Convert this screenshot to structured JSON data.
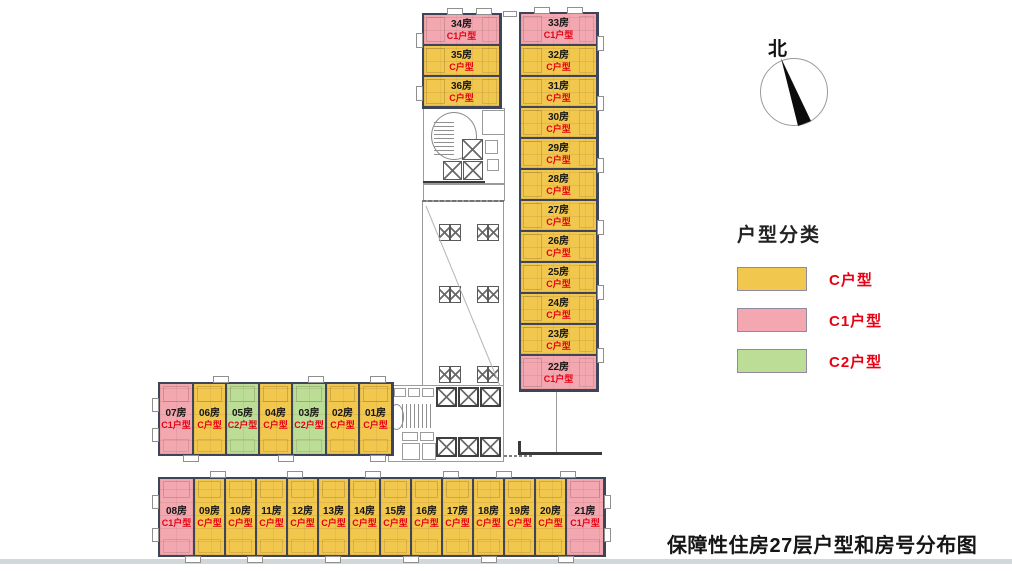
{
  "compass": {
    "label": "北"
  },
  "legend": {
    "title": "户型分类",
    "items": [
      {
        "key": "C",
        "label": "C户型",
        "color": "#F2C74E"
      },
      {
        "key": "C1",
        "label": "C1户型",
        "color": "#F3A8B1"
      },
      {
        "key": "C2",
        "label": "C2户型",
        "color": "#BCDD95"
      }
    ]
  },
  "caption": "保障性住房27层户型和房号分布图",
  "floor_plan": {
    "groups": [
      {
        "id": "tower-top-left",
        "rooms": [
          {
            "no": "34房",
            "type": "C1户型",
            "key": "C1"
          },
          {
            "no": "35房",
            "type": "C户型",
            "key": "C"
          },
          {
            "no": "36房",
            "type": "C户型",
            "key": "C"
          }
        ]
      },
      {
        "id": "tower-right",
        "rooms": [
          {
            "no": "33房",
            "type": "C1户型",
            "key": "C1"
          },
          {
            "no": "32房",
            "type": "C户型",
            "key": "C"
          },
          {
            "no": "31房",
            "type": "C户型",
            "key": "C"
          },
          {
            "no": "30房",
            "type": "C户型",
            "key": "C"
          },
          {
            "no": "29房",
            "type": "C户型",
            "key": "C"
          },
          {
            "no": "28房",
            "type": "C户型",
            "key": "C"
          },
          {
            "no": "27房",
            "type": "C户型",
            "key": "C"
          },
          {
            "no": "26房",
            "type": "C户型",
            "key": "C"
          },
          {
            "no": "25房",
            "type": "C户型",
            "key": "C"
          },
          {
            "no": "24房",
            "type": "C户型",
            "key": "C"
          },
          {
            "no": "23房",
            "type": "C户型",
            "key": "C"
          },
          {
            "no": "22房",
            "type": "C1户型",
            "key": "C1"
          }
        ]
      },
      {
        "id": "strip-middle",
        "rooms": [
          {
            "no": "07房",
            "type": "C1户型",
            "key": "C1"
          },
          {
            "no": "06房",
            "type": "C户型",
            "key": "C"
          },
          {
            "no": "05房",
            "type": "C2户型",
            "key": "C2"
          },
          {
            "no": "04房",
            "type": "C户型",
            "key": "C"
          },
          {
            "no": "03房",
            "type": "C2户型",
            "key": "C2"
          },
          {
            "no": "02房",
            "type": "C户型",
            "key": "C"
          },
          {
            "no": "01房",
            "type": "C户型",
            "key": "C"
          }
        ]
      },
      {
        "id": "strip-bottom",
        "rooms": [
          {
            "no": "08房",
            "type": "C1户型",
            "key": "C1"
          },
          {
            "no": "09房",
            "type": "C户型",
            "key": "C"
          },
          {
            "no": "10房",
            "type": "C户型",
            "key": "C"
          },
          {
            "no": "11房",
            "type": "C户型",
            "key": "C"
          },
          {
            "no": "12房",
            "type": "C户型",
            "key": "C"
          },
          {
            "no": "13房",
            "type": "C户型",
            "key": "C"
          },
          {
            "no": "14房",
            "type": "C户型",
            "key": "C"
          },
          {
            "no": "15房",
            "type": "C户型",
            "key": "C"
          },
          {
            "no": "16房",
            "type": "C户型",
            "key": "C"
          },
          {
            "no": "17房",
            "type": "C户型",
            "key": "C"
          },
          {
            "no": "18房",
            "type": "C户型",
            "key": "C"
          },
          {
            "no": "19房",
            "type": "C户型",
            "key": "C"
          },
          {
            "no": "20房",
            "type": "C户型",
            "key": "C"
          },
          {
            "no": "21房",
            "type": "C1户型",
            "key": "C1"
          }
        ]
      }
    ]
  }
}
